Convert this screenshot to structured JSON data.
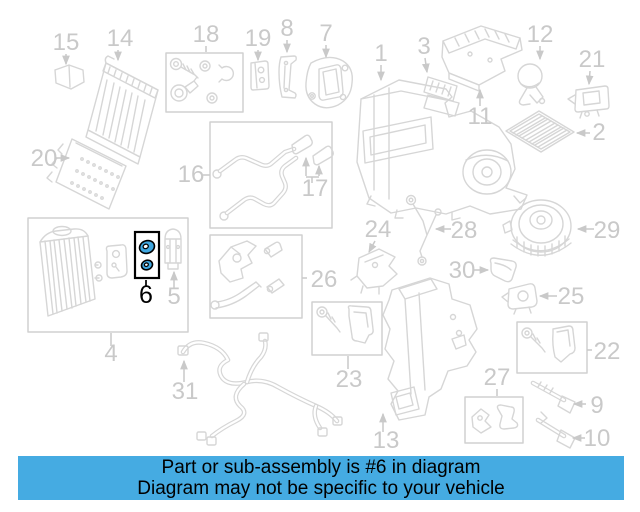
{
  "diagram": {
    "banner": {
      "line1": "Part or sub-assembly is #6 in diagram",
      "line2": "Diagram may not be specific to your vehicle"
    },
    "colors": {
      "highlight": "#3fa7e0",
      "highlight_outline": "#000000",
      "banner_bg": "#45abe2",
      "banner_text": "#000000",
      "line_art": "#d6d6d6",
      "box_outline": "#d0d0d0",
      "label_gray": "#c9c9c9"
    },
    "highlighted_part": "6",
    "labels": [
      {
        "id": "1",
        "x": 381,
        "y": 61,
        "arrow": [
          381,
          65,
          381,
          80
        ]
      },
      {
        "id": "2",
        "x": 599,
        "y": 140,
        "arrow": [
          590,
          133,
          577,
          133
        ]
      },
      {
        "id": "3",
        "x": 424,
        "y": 54,
        "arrow": [
          425,
          58,
          427,
          72
        ]
      },
      {
        "id": "4",
        "x": 111,
        "y": 361,
        "leader": [
          111,
          333,
          111,
          346
        ]
      },
      {
        "id": "5",
        "x": 174,
        "y": 304,
        "arrow": [
          174,
          288,
          174,
          272
        ]
      },
      {
        "id": "6",
        "x": 146,
        "y": 303,
        "leader": [
          146,
          280,
          146,
          287
        ],
        "highlight": true
      },
      {
        "id": "7",
        "x": 326,
        "y": 41,
        "arrow": [
          326,
          45,
          326,
          57
        ]
      },
      {
        "id": "8",
        "x": 287,
        "y": 36,
        "arrow": [
          287,
          40,
          287,
          52
        ]
      },
      {
        "id": "9",
        "x": 597,
        "y": 413,
        "arrow": [
          586,
          404,
          574,
          404
        ]
      },
      {
        "id": "10",
        "x": 597,
        "y": 446,
        "arrow": [
          585,
          438,
          573,
          438
        ]
      },
      {
        "id": "11",
        "x": 480,
        "y": 124,
        "arrow": [
          480,
          106,
          480,
          90
        ]
      },
      {
        "id": "12",
        "x": 540,
        "y": 42,
        "arrow": [
          540,
          46,
          540,
          59
        ]
      },
      {
        "id": "13",
        "x": 386,
        "y": 448,
        "arrow": [
          383,
          432,
          383,
          414
        ]
      },
      {
        "id": "14",
        "x": 120,
        "y": 46,
        "arrow": [
          118,
          50,
          118,
          60
        ]
      },
      {
        "id": "15",
        "x": 66,
        "y": 50,
        "arrow": [
          66,
          54,
          66,
          64
        ]
      },
      {
        "id": "16",
        "x": 191,
        "y": 182,
        "leader": [
          203,
          175,
          210,
          175
        ]
      },
      {
        "id": "17",
        "x": 315,
        "y": 196,
        "lines": [
          [
            306,
            177,
            319,
            177
          ],
          [
            312,
            177,
            312,
            183
          ]
        ],
        "arrows": [
          [
            306,
            176,
            306,
            158
          ],
          [
            319,
            176,
            319,
            166
          ]
        ]
      },
      {
        "id": "18",
        "x": 206,
        "y": 42,
        "leader": [
          206,
          46,
          206,
          52
        ]
      },
      {
        "id": "19",
        "x": 258,
        "y": 46,
        "arrow": [
          258,
          50,
          258,
          60
        ]
      },
      {
        "id": "20",
        "x": 44,
        "y": 166,
        "arrow": [
          56,
          158,
          69,
          158
        ]
      },
      {
        "id": "21",
        "x": 592,
        "y": 67,
        "arrow": [
          590,
          71,
          589,
          84
        ]
      },
      {
        "id": "22",
        "x": 607,
        "y": 359,
        "leader": [
          587,
          350,
          592,
          350
        ]
      },
      {
        "id": "23",
        "x": 349,
        "y": 387,
        "leader": [
          348,
          356,
          348,
          369
        ]
      },
      {
        "id": "24",
        "x": 378,
        "y": 237,
        "arrow": [
          375,
          241,
          369,
          252
        ]
      },
      {
        "id": "25",
        "x": 571,
        "y": 304,
        "arrow": [
          557,
          296,
          540,
          296
        ]
      },
      {
        "id": "26",
        "x": 324,
        "y": 287,
        "leader": [
          302,
          278,
          307,
          278
        ]
      },
      {
        "id": "27",
        "x": 497,
        "y": 385,
        "leader": [
          497,
          389,
          497,
          396
        ]
      },
      {
        "id": "28",
        "x": 464,
        "y": 238,
        "arrow": [
          451,
          229,
          436,
          229
        ]
      },
      {
        "id": "29",
        "x": 607,
        "y": 238,
        "arrow": [
          594,
          229,
          578,
          229
        ]
      },
      {
        "id": "30",
        "x": 462,
        "y": 278,
        "arrow": [
          474,
          270,
          488,
          270
        ]
      },
      {
        "id": "31",
        "x": 185,
        "y": 399,
        "arrow": [
          184,
          382,
          184,
          361
        ]
      }
    ]
  }
}
